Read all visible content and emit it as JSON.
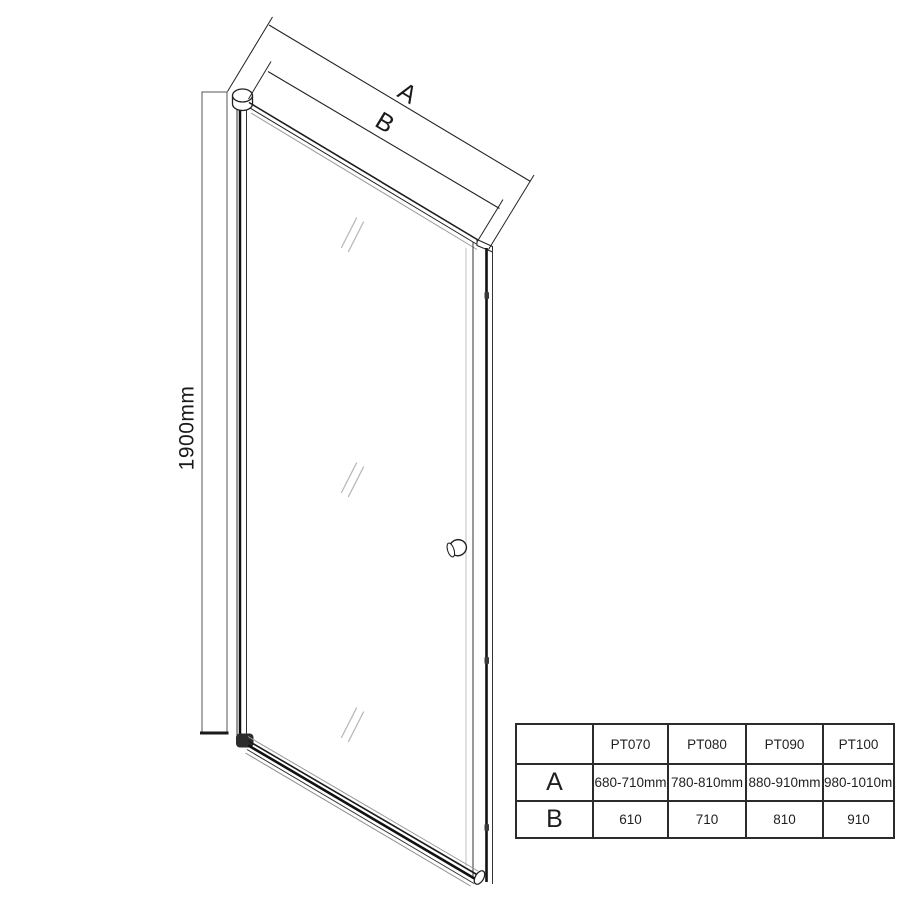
{
  "diagram": {
    "title_semantic": "pivot shower door dimension drawing",
    "height_label": "1900mm",
    "dim_a_label": "A",
    "dim_b_label": "B"
  },
  "table": {
    "corner_cell": "",
    "column_headers": [
      "PT070",
      "PT080",
      "PT090",
      "PT100"
    ],
    "rows": [
      {
        "label": "A",
        "values": [
          "680-710mm",
          "780-810mm",
          "880-910mm",
          "980-1010mm"
        ]
      },
      {
        "label": "B",
        "values": [
          "610",
          "710",
          "810",
          "910"
        ]
      }
    ]
  },
  "colors": {
    "line": "#1c1c1c",
    "light_line": "#9a9a9a",
    "reflection": "#b8b8b8",
    "background": "#ffffff"
  }
}
